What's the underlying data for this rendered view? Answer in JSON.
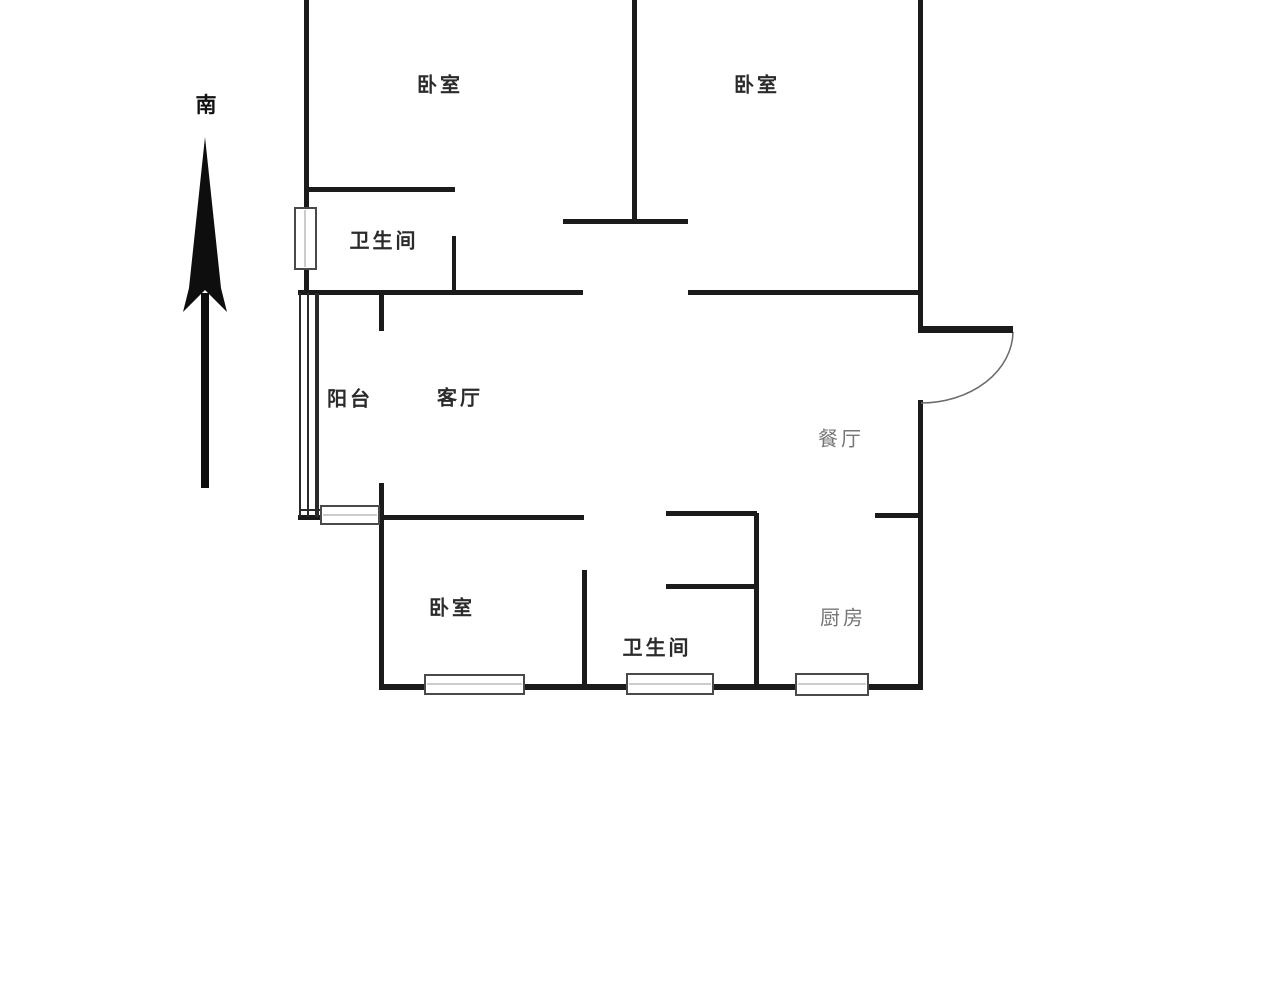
{
  "title": "apartment-floor-plan",
  "compass": {
    "label": "南"
  },
  "rooms": [
    {
      "id": "bedroom-top-left",
      "label": "卧室",
      "x": 440,
      "y": 83,
      "muted": false
    },
    {
      "id": "bedroom-top-right",
      "label": "卧室",
      "x": 757,
      "y": 83,
      "muted": false
    },
    {
      "id": "bathroom-top",
      "label": "卫生间",
      "x": 384,
      "y": 239,
      "muted": false
    },
    {
      "id": "balcony",
      "label": "阳台",
      "x": 350,
      "y": 397,
      "muted": false
    },
    {
      "id": "living-room",
      "label": "客厅",
      "x": 460,
      "y": 396,
      "muted": false
    },
    {
      "id": "dining-room",
      "label": "餐厅",
      "x": 841,
      "y": 437,
      "muted": true
    },
    {
      "id": "bedroom-bottom",
      "label": "卧室",
      "x": 452,
      "y": 606,
      "muted": false
    },
    {
      "id": "bathroom-bottom",
      "label": "卫生间",
      "x": 657,
      "y": 646,
      "muted": false
    },
    {
      "id": "kitchen",
      "label": "厨房",
      "x": 843,
      "y": 616,
      "muted": true
    }
  ],
  "colors": {
    "wall": "#1b1b1b",
    "window_border": "#4a4a4a",
    "window_fill": "#ffffff",
    "door_arc": "#6a6a6a",
    "background": "#ffffff"
  }
}
